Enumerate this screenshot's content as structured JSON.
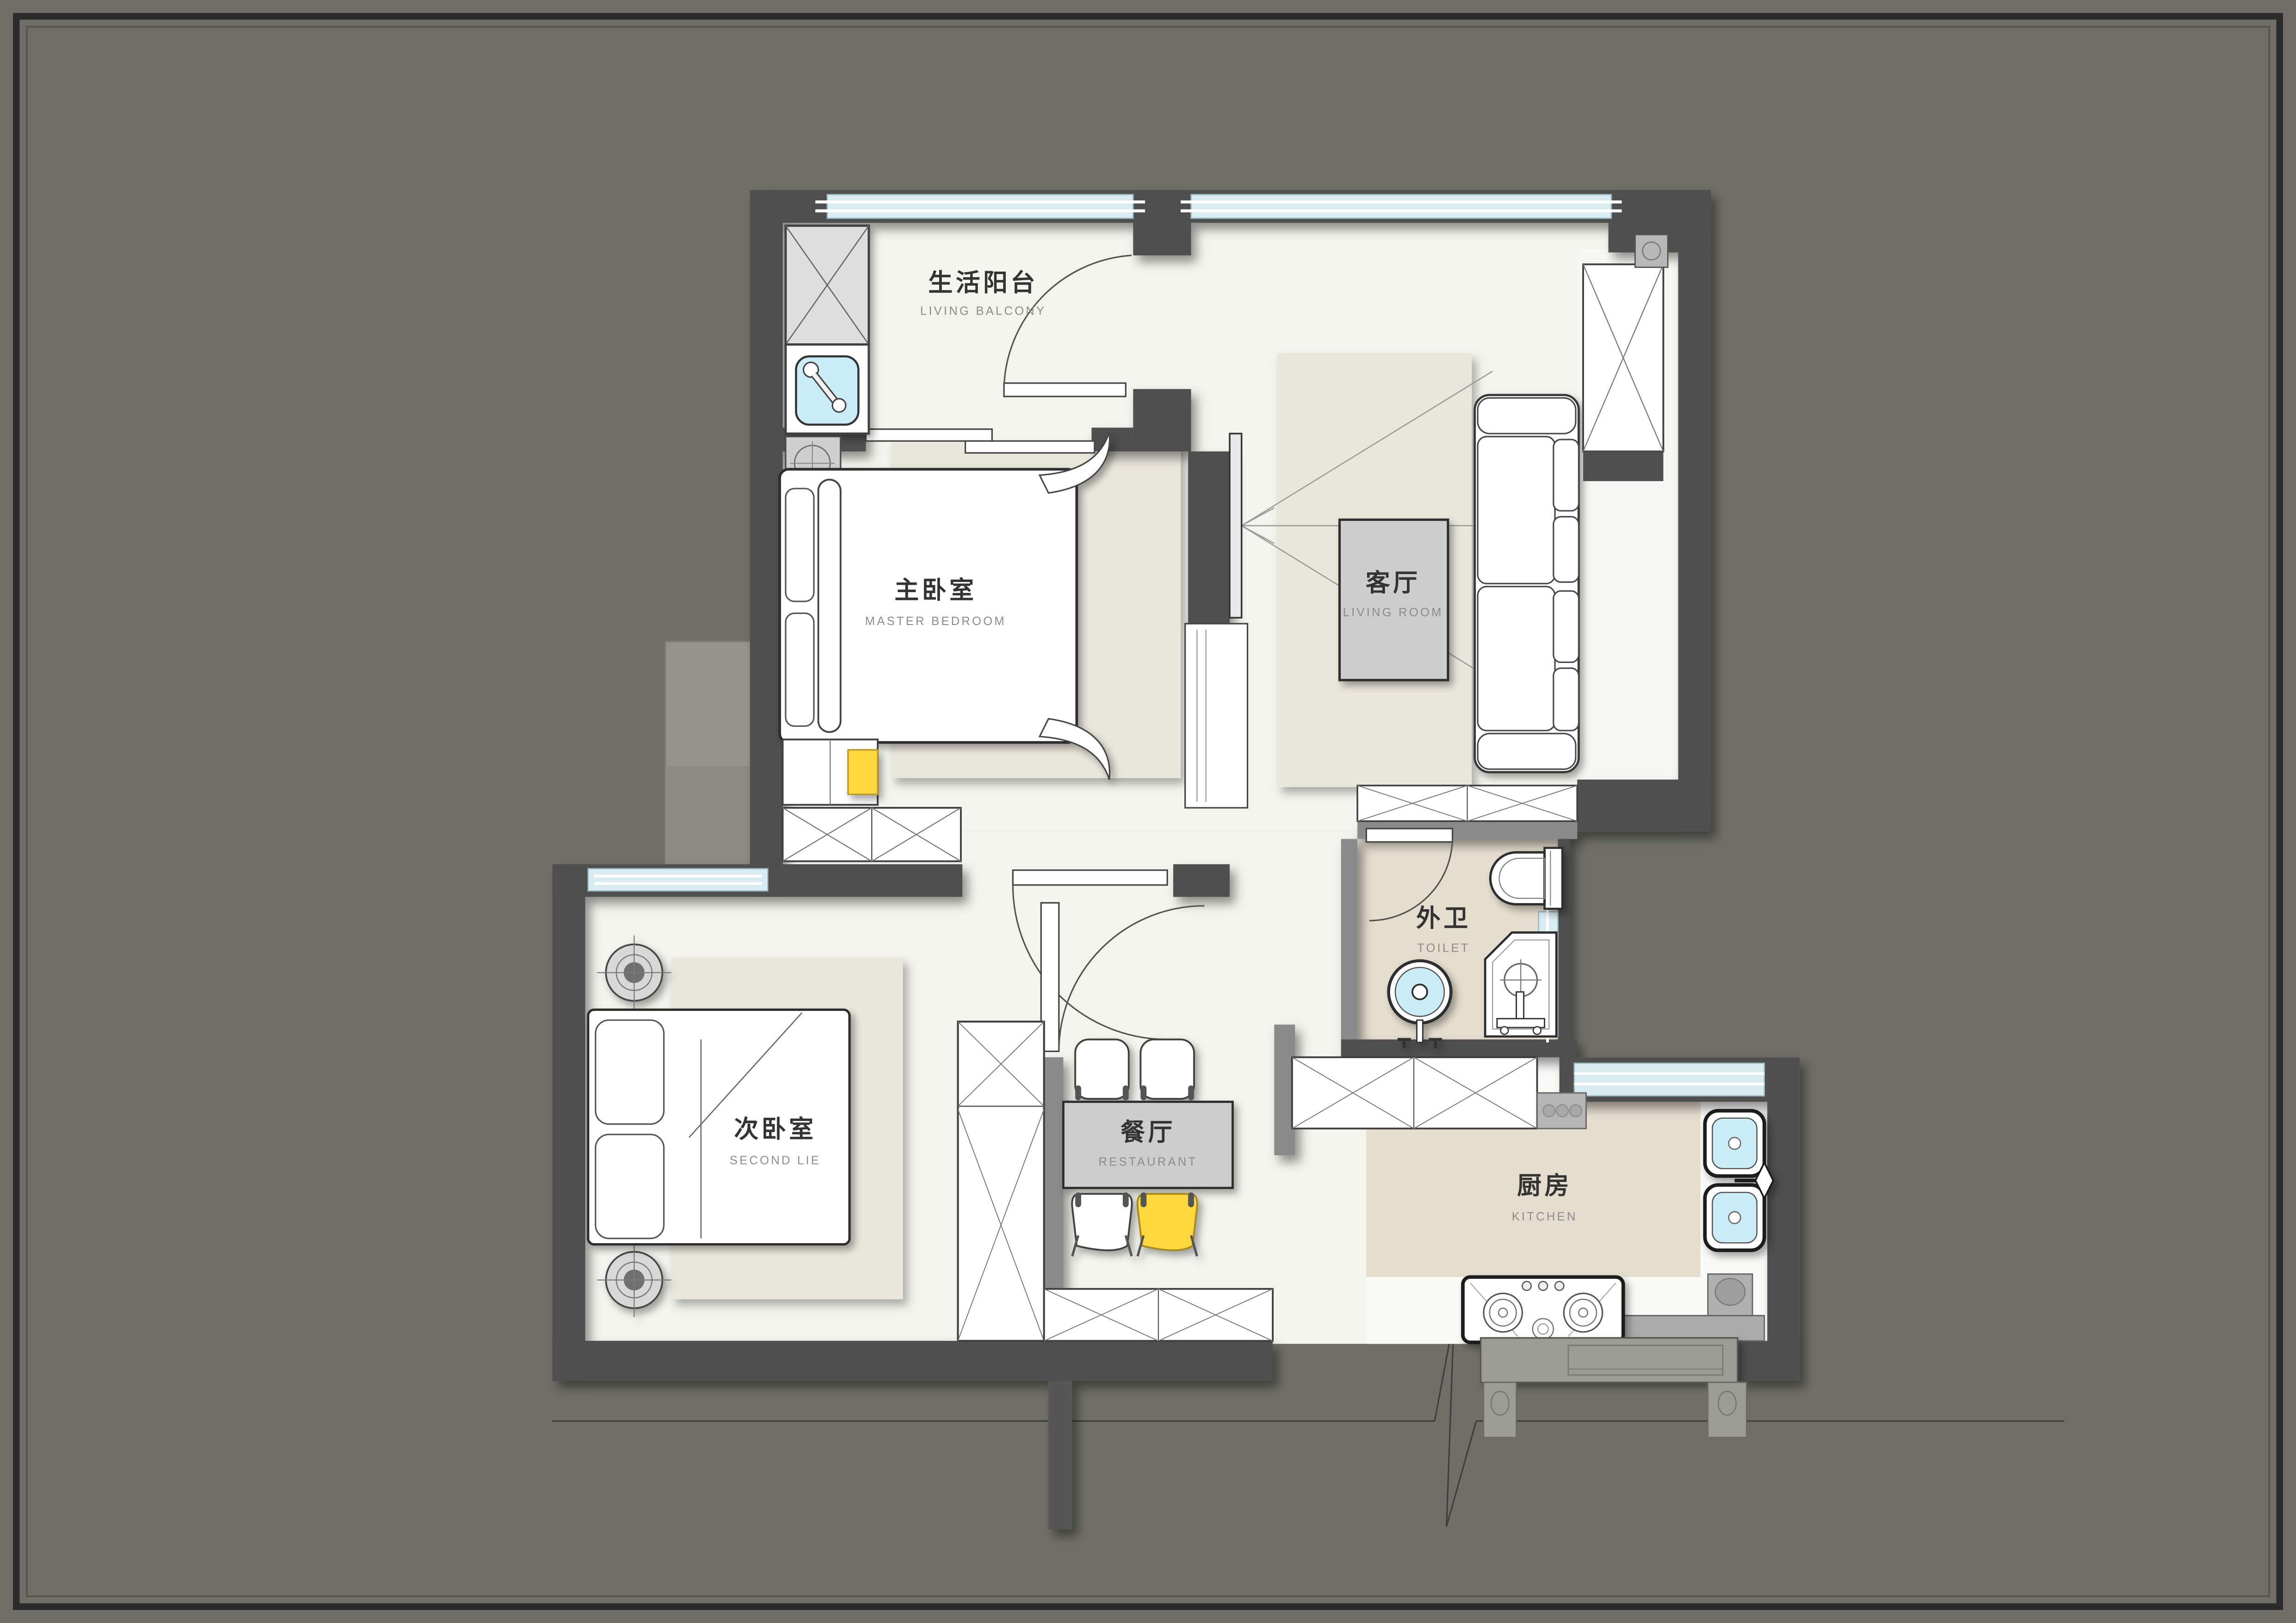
{
  "page": {
    "background": "#6f6f67",
    "frame_color": "#2b2b2b",
    "type": "apartment floor plan"
  },
  "colors": {
    "wall": "#4f4f4f",
    "wall_light": "#8a8a8a",
    "floor": "#f4f4ee",
    "area_rug": "#e9e6db",
    "tile_floor": "#e5decf",
    "window_glass": "#d8ecf2",
    "fixture_water": "#c9ecf6",
    "accent_yellow": "#ffd83c",
    "furniture_grey": "#cdcdcd",
    "label_zh": "#333333",
    "label_en": "#8c8c8c"
  },
  "rooms": {
    "living_balcony": {
      "zh": "生活阳台",
      "en": "LIVING BALCONY"
    },
    "master_bedroom": {
      "zh": "主卧室",
      "en": "MASTER BEDROOM"
    },
    "living_room": {
      "zh": "客厅",
      "en": "LIVING ROOM"
    },
    "second_bedroom": {
      "zh": "次卧室",
      "en": "SECOND LIE"
    },
    "dining_room": {
      "zh": "餐厅",
      "en": "RESTAURANT"
    },
    "toilet": {
      "zh": "外卫",
      "en": "TOILET"
    },
    "kitchen": {
      "zh": "厨房",
      "en": "KITCHEN"
    }
  },
  "icons": [
    "washing-machine-icon",
    "balcony-sink-icon",
    "bed-icon",
    "wardrobe-icon",
    "tv-icon",
    "sofa-icon",
    "coffee-table-icon",
    "dining-table-icon",
    "chair-icon",
    "wc-icon",
    "washbasin-icon",
    "shower-icon",
    "gas-stove-icon",
    "kitchen-sink-icon",
    "pouf-icon",
    "door-swing-icon",
    "break-line-icon"
  ]
}
